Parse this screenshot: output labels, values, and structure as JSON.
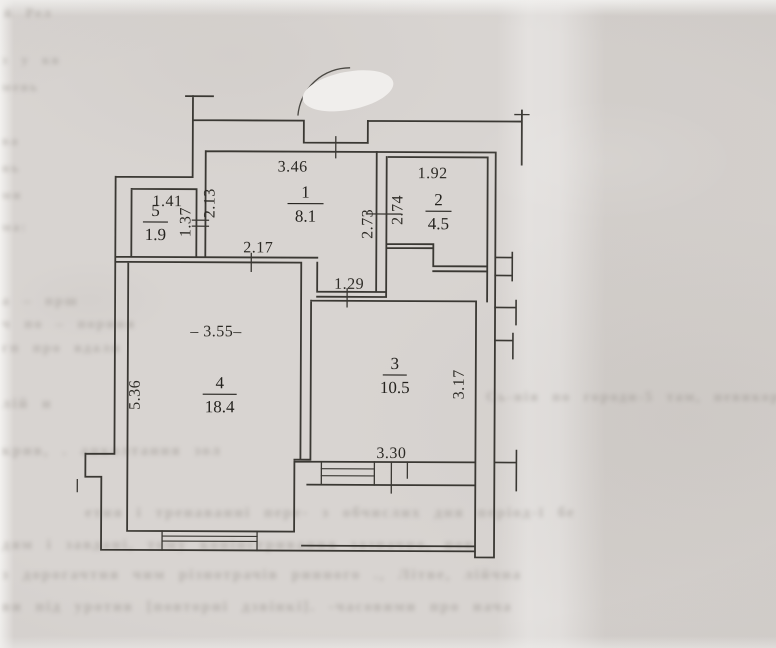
{
  "colors": {
    "paper": "#d8d4d1",
    "ink": "#3a3833",
    "label_ink": "#24221e",
    "bleed_text": "#857f78",
    "redaction_blob": "#f0eeec"
  },
  "floor_plan": {
    "rooms": [
      {
        "number": "1",
        "area": "8.1",
        "x": 305,
        "y": 198,
        "underline_w": 36
      },
      {
        "number": "2",
        "area": "4.5",
        "x": 438,
        "y": 205,
        "underline_w": 26
      },
      {
        "number": "3",
        "area": "10.5",
        "x": 395,
        "y": 369,
        "underline_w": 24
      },
      {
        "number": "4",
        "area": "18.4",
        "x": 220,
        "y": 389,
        "underline_w": 34
      },
      {
        "number": "5",
        "area": "1.9",
        "x": 155,
        "y": 217,
        "underline_w": 25
      }
    ],
    "dimensions": [
      {
        "text": "3.46",
        "x": 292,
        "y": 172,
        "rotate": 0
      },
      {
        "text": "1.92",
        "x": 432,
        "y": 178,
        "rotate": 0
      },
      {
        "text": "1.41",
        "x": 167,
        "y": 207,
        "rotate": 0
      },
      {
        "text": "1.37",
        "x": 190,
        "y": 223,
        "rotate": -90
      },
      {
        "text": "2.13",
        "x": 214,
        "y": 204,
        "rotate": -90
      },
      {
        "text": "2.73",
        "x": 372,
        "y": 224,
        "rotate": -90
      },
      {
        "text": "2.74",
        "x": 402,
        "y": 210,
        "rotate": -90
      },
      {
        "text": "2.17",
        "x": 258,
        "y": 253,
        "rotate": 0
      },
      {
        "text": "1.29",
        "x": 349,
        "y": 289,
        "rotate": 0
      },
      {
        "text": "– 3.55–",
        "x": 216,
        "y": 337,
        "rotate": 0
      },
      {
        "text": "5.36",
        "x": 140,
        "y": 396,
        "rotate": -90
      },
      {
        "text": "3.17",
        "x": 464,
        "y": 384,
        "rotate": -90
      },
      {
        "text": "3.30",
        "x": 392,
        "y": 458,
        "rotate": 0
      }
    ]
  },
  "bleedthrough_lines": [
    {
      "text": "й Рел",
      "x": 4,
      "y": 5,
      "size": 13
    },
    {
      "text": "з у кв",
      "x": 2,
      "y": 52,
      "size": 13
    },
    {
      "text": "мень",
      "x": 2,
      "y": 79,
      "size": 13
    },
    {
      "text": "ва",
      "x": 2,
      "y": 133,
      "size": 13
    },
    {
      "text": "нь",
      "x": 2,
      "y": 160,
      "size": 13
    },
    {
      "text": "ми",
      "x": 2,
      "y": 187,
      "size": 13
    },
    {
      "text": "ма:",
      "x": 2,
      "y": 219,
      "size": 13
    },
    {
      "text": "а – прш",
      "x": 2,
      "y": 294,
      "size": 14
    },
    {
      "text": "ч по – порння",
      "x": 2,
      "y": 317,
      "size": 14
    },
    {
      "text": "гп про вдалн",
      "x": 2,
      "y": 341,
      "size": 14
    },
    {
      "text": "лій н",
      "x": 2,
      "y": 396,
      "size": 15
    },
    {
      "text": "Сь-нія по городн-5 там, невикор. Очі тлив інших",
      "x": 486,
      "y": 390,
      "size": 14
    },
    {
      "text": "крив, . анколтання зол",
      "x": 2,
      "y": 443,
      "size": 15
    },
    {
      "text": "етня і тренаванні пере- з обчислих дня період-ї бе",
      "x": 85,
      "y": 505,
      "size": 15
    },
    {
      "text": "дям і завдані, тому конінстривання зазначно,  пов",
      "x": 2,
      "y": 537,
      "size": 15
    },
    {
      "text": "з дорогачтня чим різнотрачів ринного ., Літве, лійчна",
      "x": 2,
      "y": 567,
      "size": 15
    },
    {
      "text": "ви під уротив [повторні дзвінкі].  -часовими про нача",
      "x": 2,
      "y": 599,
      "size": 15
    }
  ]
}
